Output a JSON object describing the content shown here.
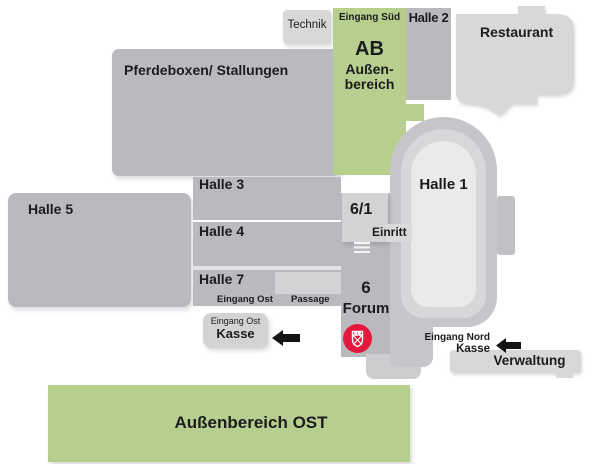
{
  "colors": {
    "green": "#b7cf8e",
    "hall-gray": "#bababe",
    "light-gray": "#d8d8da",
    "box-light": "#d3d3d5",
    "stadium-outer": "#c6c6ca",
    "stadium-mid": "#d7d7d9",
    "stadium-inner": "#eaeaec",
    "logo-red": "#e5173d",
    "arrow-black": "#141414",
    "text": "#1c1c1e"
  },
  "areas": {
    "technik": {
      "label": "Technik"
    },
    "pferdeboxen": {
      "label": "Pferdeboxen/ Stallungen"
    },
    "aussenbereich_sued": {
      "entrance": "Eingang Süd",
      "code": "AB",
      "name_line1": "Außen-",
      "name_line2": "bereich"
    },
    "halle2": {
      "label": "Halle 2"
    },
    "restaurant": {
      "label": "Restaurant"
    },
    "halle1": {
      "label": "Halle 1"
    },
    "halle3": {
      "label": "Halle 3"
    },
    "halle4": {
      "label": "Halle 4"
    },
    "halle5": {
      "label": "Halle 5"
    },
    "halle7": {
      "label": "Halle 7"
    },
    "halle6_1": {
      "label": "6/1"
    },
    "einritt": {
      "label": "Einritt"
    },
    "eingang_ost_strip": {
      "label": "Eingang Ost"
    },
    "passage": {
      "label": "Passage"
    },
    "forum": {
      "number": "6",
      "label": "Forum"
    },
    "kasse_ost": {
      "entrance": "Eingang Ost",
      "label": "Kasse"
    },
    "kasse_nord": {
      "entrance": "Eingang Nord",
      "label": "Kasse"
    },
    "verwaltung": {
      "label": "Verwaltung"
    },
    "aussenbereich_ost": {
      "label": "Außenbereich OST"
    }
  },
  "icons": {
    "fair_logo": "red circle crest: white crenellated shield with saltire cross",
    "direction_arrows": "solid black arrow pointing left",
    "stairs": "horizontal bar steps"
  }
}
